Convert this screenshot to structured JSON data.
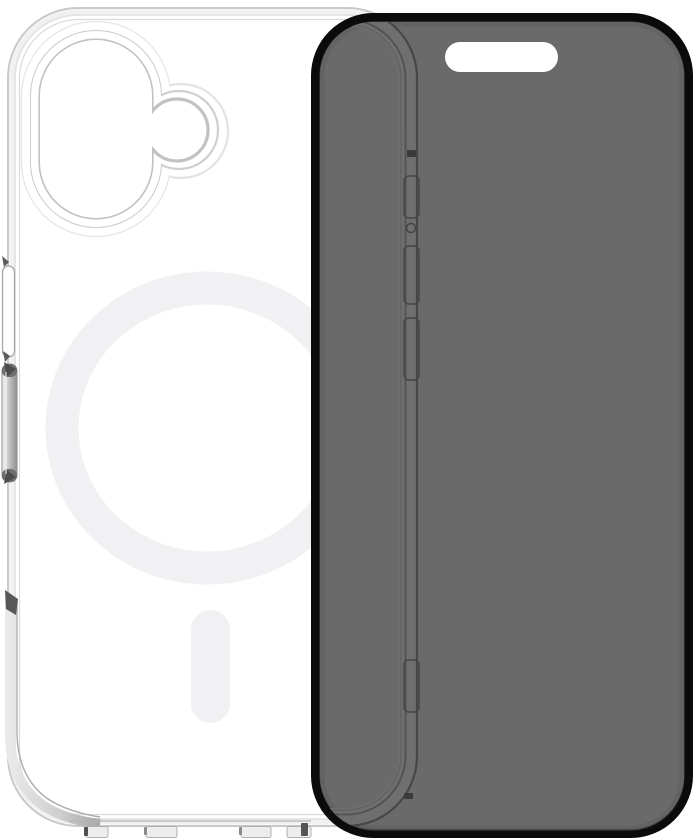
{
  "scene": {
    "kind": "product-photo",
    "items": {
      "case": {
        "name": "clear-magsafe-phone-case",
        "view": "rear",
        "features": [
          "camera-cutout",
          "magsafe-ring",
          "magsafe-alignment-line",
          "side-button-slot",
          "volume-button",
          "bottom-speaker-notches"
        ]
      },
      "screen_protector": {
        "name": "privacy-screen-protector",
        "view": "front",
        "features": [
          "black-border",
          "tinted-glass",
          "earpiece-cutout",
          "case-edge-visible-through-glass",
          "side-button-slots"
        ]
      }
    }
  },
  "colors": {
    "bg": "#ffffff",
    "glass-fill": "#6a6a6a",
    "glass-border": "#0b0b0b",
    "case-line": "#c9c9c9",
    "case-line-light": "#e3e3e3",
    "magsafe": "#f1f1f3",
    "metal-mid": "#a8a8a8",
    "through-line": "#474747",
    "through-band": "#707070"
  }
}
